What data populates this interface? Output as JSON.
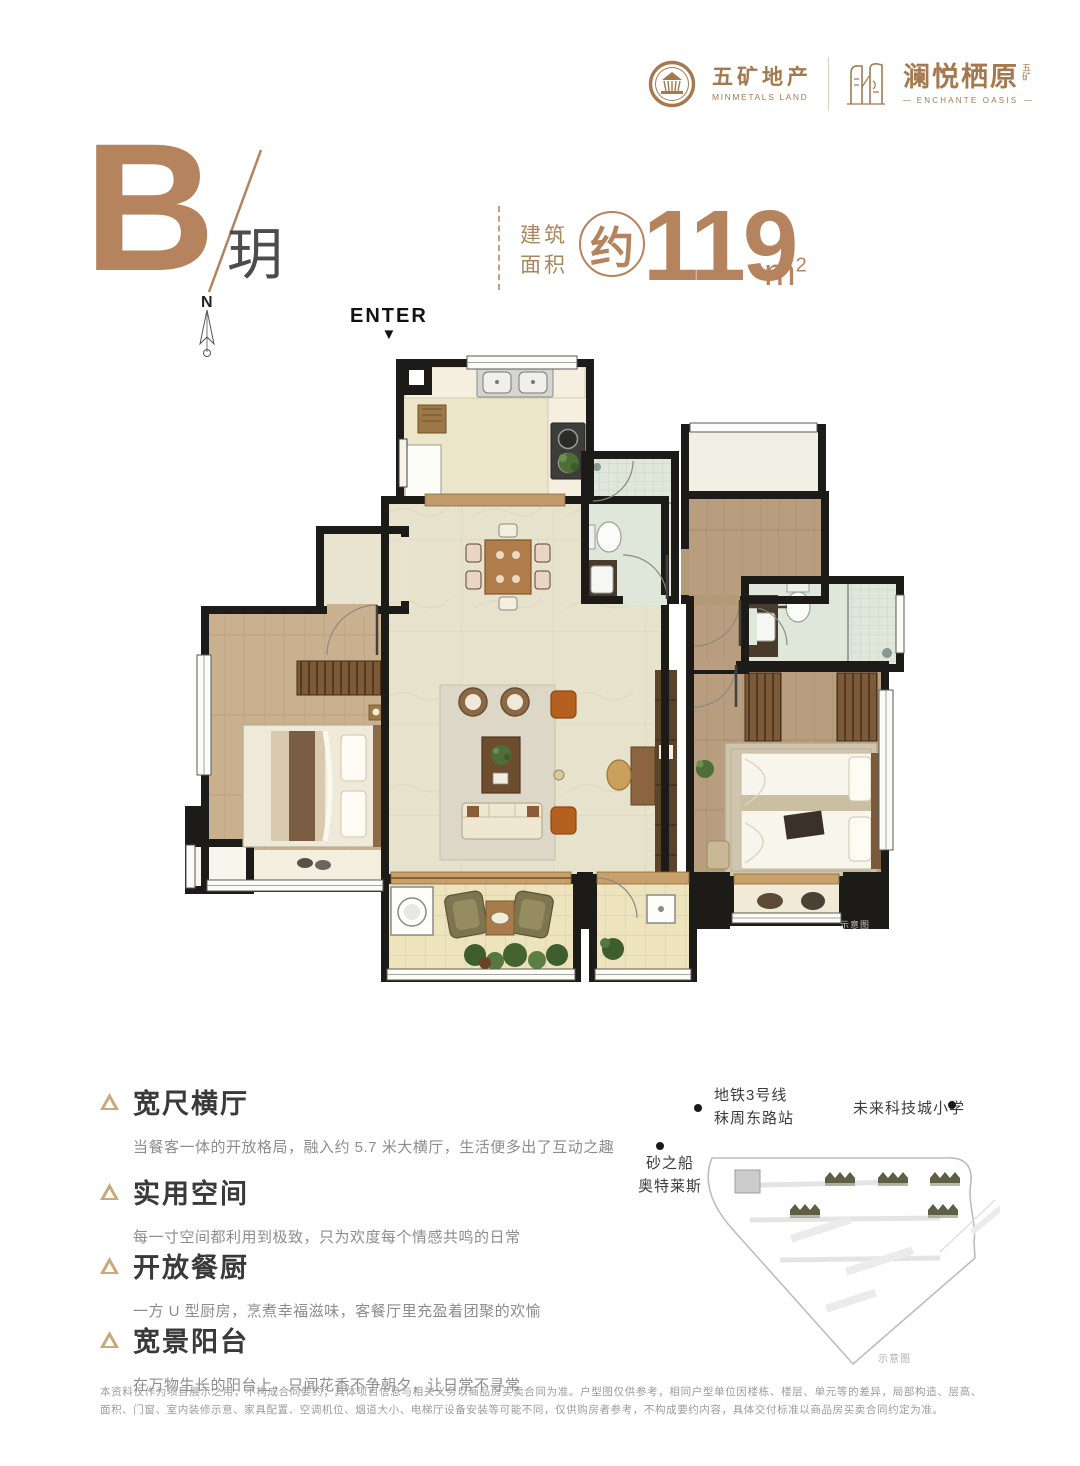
{
  "brand": {
    "minmetals": {
      "cn": "五矿地产",
      "en": "MINMETALS LAND"
    },
    "project": {
      "cn": "澜悦栖原",
      "sup": "五矿",
      "en": "ENCHANTE OASIS"
    }
  },
  "title": {
    "unit": "B",
    "unit_name": "玥",
    "area_prefix_line1": "建筑",
    "area_prefix_line2": "面积",
    "approx": "约",
    "area_value": "119",
    "area_unit_m": "m",
    "area_unit_sup": "2"
  },
  "plan": {
    "north": "N",
    "enter": "ENTER",
    "enter_arrow": "▼",
    "watermark": "示意图"
  },
  "features": [
    {
      "title": "宽尺横厅",
      "desc": "当餐客一体的开放格局，融入约 5.7 米大横厅，生活便多出了互动之趣"
    },
    {
      "title": "实用空间",
      "desc": "每一寸空间都利用到极致，只为欢度每个情感共鸣的日常"
    },
    {
      "title": "开放餐厨",
      "desc": "一方 U 型厨房，烹煮幸福滋味，客餐厅里充盈着团聚的欢愉"
    },
    {
      "title": "宽景阳台",
      "desc": "在万物生长的阳台上，只闻花香不争朝夕，让日常不寻常"
    }
  ],
  "map": {
    "pois": [
      {
        "line1": "地铁3号线",
        "line2": "秣周东路站"
      },
      {
        "line1": "未来科技城小学",
        "line2": ""
      },
      {
        "line1": "砂之船",
        "line2": "奥特莱斯"
      }
    ],
    "caption": "示意图"
  },
  "disclaimer": "本资料仅作为项目展示之用，不构成合同要约；具体项目信息与相关义务以商品房买卖合同为准。户型图仅供参考，相同户型单位因楼栋、楼层、单元等的差异，局部构造、层高、面积、门窗、室内装修示意、家具配置、空调机位、烟道大小、电梯厅设备安装等可能不同，仅供购房者参考，不构成要约内容，具体交付标准以商品房买卖合同约定为准。",
  "colors": {
    "brand": "#a5794e",
    "accent": "#b5835d",
    "wall": "#1d1b17"
  }
}
